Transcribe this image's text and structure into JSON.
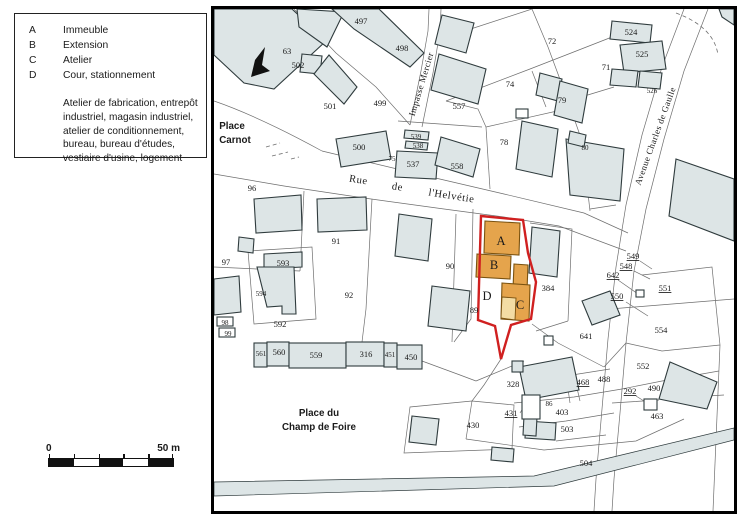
{
  "colors": {
    "map_border": "#000000",
    "parcel_line": "#6e6e6e",
    "building_fill": "#dde5e6",
    "building_stroke": "#2f3b3d",
    "highlight_orange": "#e5a44c",
    "highlight_light": "#f3dca4",
    "highlight_red": "#d02020",
    "text": "#1a1a1a"
  },
  "legend": {
    "items": [
      {
        "key": "A",
        "label": "Immeuble"
      },
      {
        "key": "B",
        "label": "Extension"
      },
      {
        "key": "C",
        "label": "Atelier"
      },
      {
        "key": "D",
        "label": "Cour, stationnement"
      }
    ],
    "description": "Atelier de fabrication, entrepôt industriel, magasin industriel, atelier de conditionnement, bureau, bureau d'études, vestiaire d'usine, logement"
  },
  "scale_bar": {
    "start": "0",
    "end": "50 m"
  },
  "map": {
    "labels": [
      {
        "t": "497",
        "x": 147,
        "y": 15
      },
      {
        "t": "498",
        "x": 188,
        "y": 42
      },
      {
        "t": "63",
        "x": 73,
        "y": 45
      },
      {
        "t": "502",
        "x": 84,
        "y": 59
      },
      {
        "t": "499",
        "x": 166,
        "y": 97
      },
      {
        "t": "501",
        "x": 116,
        "y": 100
      },
      {
        "t": "500",
        "x": 145,
        "y": 141
      },
      {
        "t": "557",
        "x": 245,
        "y": 100
      },
      {
        "t": "539",
        "x": 202,
        "y": 130,
        "c": "num-sm"
      },
      {
        "t": "538",
        "x": 204,
        "y": 139,
        "c": "num-sm"
      },
      {
        "t": "537",
        "x": 199,
        "y": 158
      },
      {
        "t": "558",
        "x": 243,
        "y": 160
      },
      {
        "t": "75",
        "x": 178,
        "y": 152,
        "c": "num-sm"
      },
      {
        "t": "78",
        "x": 290,
        "y": 136
      },
      {
        "t": "72",
        "x": 338,
        "y": 35
      },
      {
        "t": "74",
        "x": 296,
        "y": 78
      },
      {
        "t": "79",
        "x": 348,
        "y": 94
      },
      {
        "t": "71",
        "x": 392,
        "y": 61
      },
      {
        "t": "524",
        "x": 417,
        "y": 26
      },
      {
        "t": "525",
        "x": 428,
        "y": 48
      },
      {
        "t": "526",
        "x": 438,
        "y": 84,
        "c": "num-sm"
      },
      {
        "t": "80",
        "x": 371,
        "y": 141,
        "c": "num-sm"
      },
      {
        "t": "96",
        "x": 38,
        "y": 182
      },
      {
        "t": "97",
        "x": 12,
        "y": 256
      },
      {
        "t": "91",
        "x": 122,
        "y": 235
      },
      {
        "t": "90",
        "x": 236,
        "y": 260
      },
      {
        "t": "92",
        "x": 135,
        "y": 289
      },
      {
        "t": "593",
        "x": 69,
        "y": 257
      },
      {
        "t": "594",
        "x": 47,
        "y": 287,
        "c": "num-sm"
      },
      {
        "t": "592",
        "x": 66,
        "y": 318
      },
      {
        "t": "98",
        "x": 11,
        "y": 316,
        "c": "num-sm"
      },
      {
        "t": "99",
        "x": 14,
        "y": 327,
        "c": "num-sm"
      },
      {
        "t": "561",
        "x": 47,
        "y": 347,
        "c": "num-sm"
      },
      {
        "t": "560",
        "x": 65,
        "y": 346
      },
      {
        "t": "559",
        "x": 102,
        "y": 349
      },
      {
        "t": "316",
        "x": 152,
        "y": 348
      },
      {
        "t": "451",
        "x": 176,
        "y": 348,
        "c": "num-sm"
      },
      {
        "t": "450",
        "x": 197,
        "y": 351
      },
      {
        "t": "89",
        "x": 260,
        "y": 304
      },
      {
        "t": "384",
        "x": 334,
        "y": 282
      },
      {
        "t": "549",
        "x": 419,
        "y": 250,
        "u": 1
      },
      {
        "t": "548",
        "x": 412,
        "y": 260,
        "u": 1
      },
      {
        "t": "642",
        "x": 399,
        "y": 269,
        "u": 1
      },
      {
        "t": "551",
        "x": 451,
        "y": 282,
        "u": 1
      },
      {
        "t": "550",
        "x": 403,
        "y": 290,
        "u": 1
      },
      {
        "t": "554",
        "x": 447,
        "y": 324
      },
      {
        "t": "641",
        "x": 372,
        "y": 330
      },
      {
        "t": "552",
        "x": 429,
        "y": 360
      },
      {
        "t": "488",
        "x": 390,
        "y": 373
      },
      {
        "t": "468",
        "x": 369,
        "y": 376,
        "u": 1
      },
      {
        "t": "292",
        "x": 416,
        "y": 385,
        "u": 1
      },
      {
        "t": "490",
        "x": 440,
        "y": 382
      },
      {
        "t": "463",
        "x": 443,
        "y": 410
      },
      {
        "t": "328",
        "x": 299,
        "y": 378
      },
      {
        "t": "86",
        "x": 335,
        "y": 397,
        "c": "num-sm"
      },
      {
        "t": "431",
        "x": 297,
        "y": 407,
        "u": 1
      },
      {
        "t": "403",
        "x": 348,
        "y": 406
      },
      {
        "t": "503",
        "x": 353,
        "y": 423
      },
      {
        "t": "430",
        "x": 259,
        "y": 419
      },
      {
        "t": "504",
        "x": 372,
        "y": 457
      },
      {
        "t": "A",
        "x": 287,
        "y": 236,
        "c": "letter",
        "n": "zone-a-label"
      },
      {
        "t": "B",
        "x": 280,
        "y": 260,
        "c": "letter",
        "n": "zone-b-label"
      },
      {
        "t": "C",
        "x": 306,
        "y": 300,
        "c": "letter",
        "n": "zone-c-label"
      },
      {
        "t": "D",
        "x": 273,
        "y": 291,
        "c": "letter",
        "n": "zone-d-label"
      },
      {
        "t": "Place",
        "x": 18,
        "y": 120,
        "c": "place",
        "n": "place-carnot-line1"
      },
      {
        "t": "Carnot",
        "x": 21,
        "y": 134,
        "c": "place",
        "n": "place-carnot-line2"
      },
      {
        "t": "Rue",
        "x": 144,
        "y": 174,
        "c": "street",
        "r": 9,
        "n": "rue-helvetie-word1"
      },
      {
        "t": "de",
        "x": 183,
        "y": 181,
        "c": "street",
        "r": 9,
        "n": "rue-helvetie-word2"
      },
      {
        "t": "l'Helvétie",
        "x": 237,
        "y": 190,
        "c": "street",
        "r": 9,
        "n": "rue-helvetie-word3"
      },
      {
        "t": "Impasse Mercier",
        "x": 210,
        "y": 76,
        "c": "street-sm",
        "r": -73,
        "n": "impasse-mercier-label"
      },
      {
        "t": "Avenue Charles de Gaulle",
        "x": 444,
        "y": 128,
        "c": "street-sm",
        "r": -70,
        "n": "avenue-de-gaulle-label"
      },
      {
        "t": "Place du",
        "x": 105,
        "y": 407,
        "c": "place",
        "n": "place-champ-de-foire-line1"
      },
      {
        "t": "Champ de Foire",
        "x": 105,
        "y": 421,
        "c": "place",
        "n": "place-champ-de-foire-line2"
      }
    ]
  }
}
